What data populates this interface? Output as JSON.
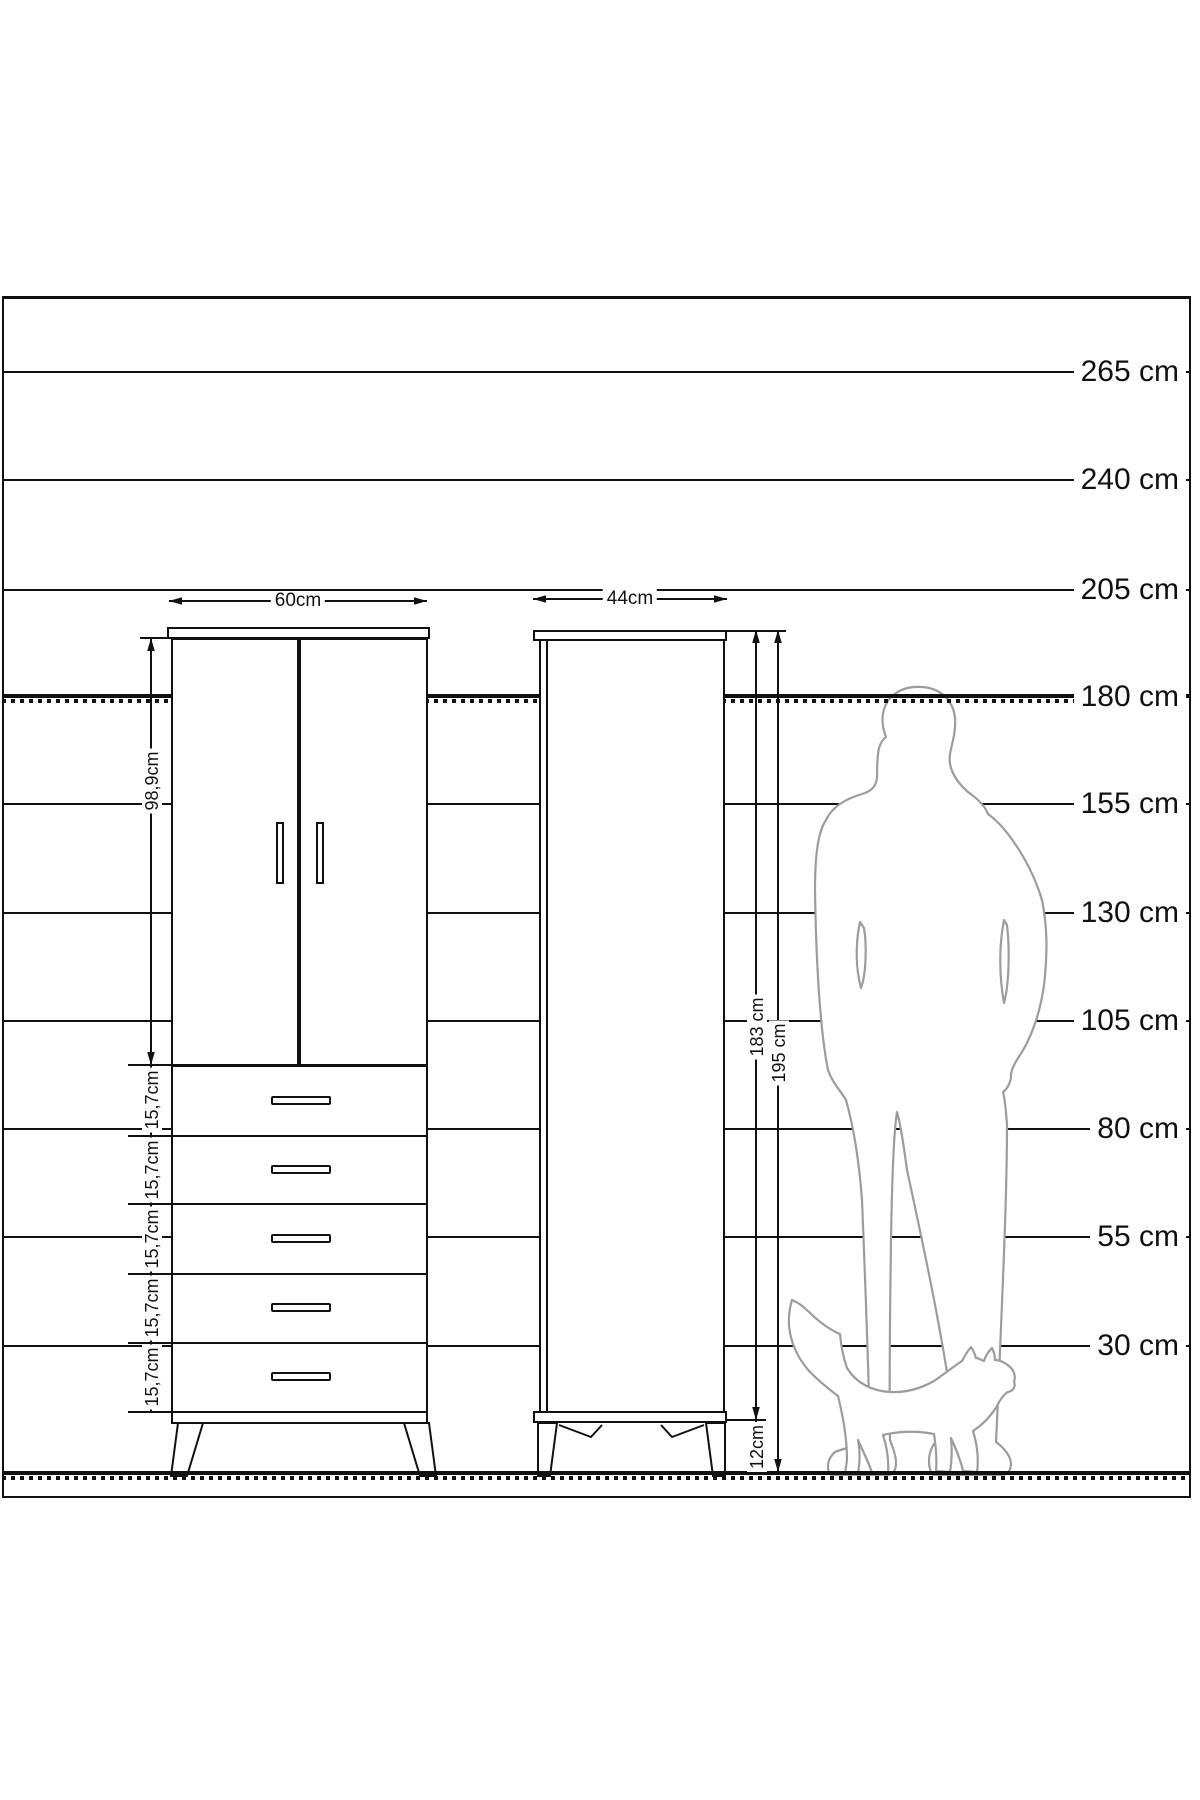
{
  "scale": {
    "unit_labels": [
      "265 cm",
      "240 cm",
      "205 cm",
      "180 cm",
      "155 cm",
      "130 cm",
      "105 cm",
      "80 cm",
      "55 cm",
      "30 cm"
    ]
  },
  "front_view": {
    "width_label": "60cm",
    "door_height_label": "98,9cm",
    "drawer_height_labels": [
      "15,7cm",
      "15,7cm",
      "15,7cm",
      "15,7cm",
      "15,7cm"
    ]
  },
  "side_view": {
    "depth_label": "44cm",
    "body_height_label": "183 cm",
    "total_height_label": "195 cm",
    "leg_height_label": "12cm"
  },
  "colors": {
    "line": "#111111",
    "silhouette": "#9c9c9c",
    "background": "#ffffff"
  }
}
